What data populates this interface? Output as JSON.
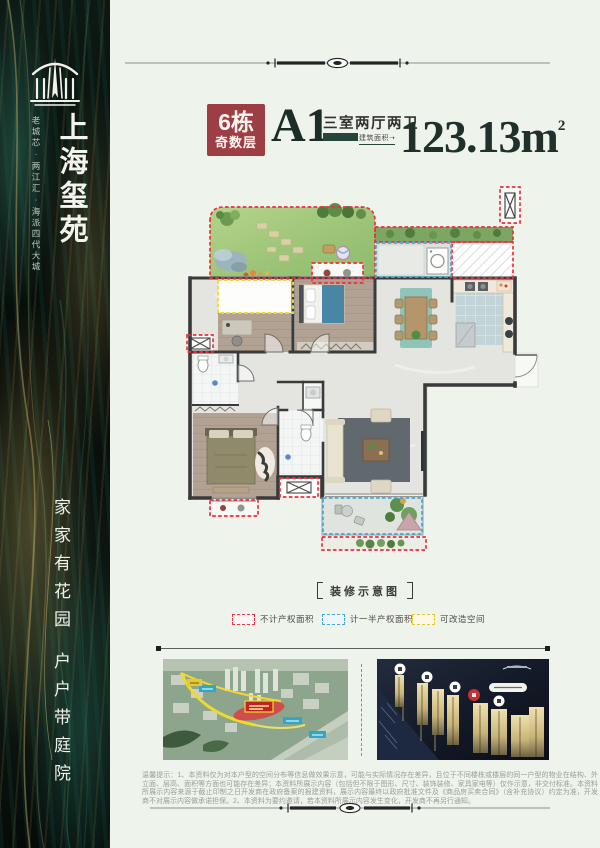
{
  "sidebar": {
    "brand_name": "上海玺苑",
    "brand_tagline": "老城芯·两江汇·海派四代大城",
    "slogan_line1": "家家有花园",
    "slogan_line2": "户户带庭院"
  },
  "header": {
    "badge_building": "6栋",
    "badge_floors": "奇数层",
    "unit_code": "A1",
    "unit_layout": "三室两厅两卫",
    "area_label": "建筑面积➝",
    "area_value": "123.13m",
    "area_superscript": "2",
    "badge_color": "#9c3e44",
    "accent_color": "#26463b"
  },
  "floor_plan": {
    "caption": "装修示意图"
  },
  "legend": {
    "items": [
      {
        "label": "不计产权面积",
        "color": "#e8374a"
      },
      {
        "label": "计一半产权面积",
        "color": "#49a8d8"
      },
      {
        "label": "可改造空间",
        "color": "#dcc73e"
      }
    ]
  },
  "disclaimer": "温馨提示：1、本资料仅为对本户型的空间分布等信息做效果示意，可能与实际情况存在差异，且位于不同楼栋或楼层的同一户型的物业在结构、外立面、层高、面积等方面也可能存在差异；本资料所展示内容（包括但不限于图形、尺寸、装饰装修、家具家电等）仅作示意，非交付标准。本资料所展示内容来源于截止印制之日开发商在政府备案的报建资料，展示内容最终以政府批准文件及《商品房买卖合同》（含补充协议）约定为准，开发商不对展示内容做承诺担保。2、本资料为要约邀请，若本资料所展示内容发生变化，开发商不再另行通知。"
}
